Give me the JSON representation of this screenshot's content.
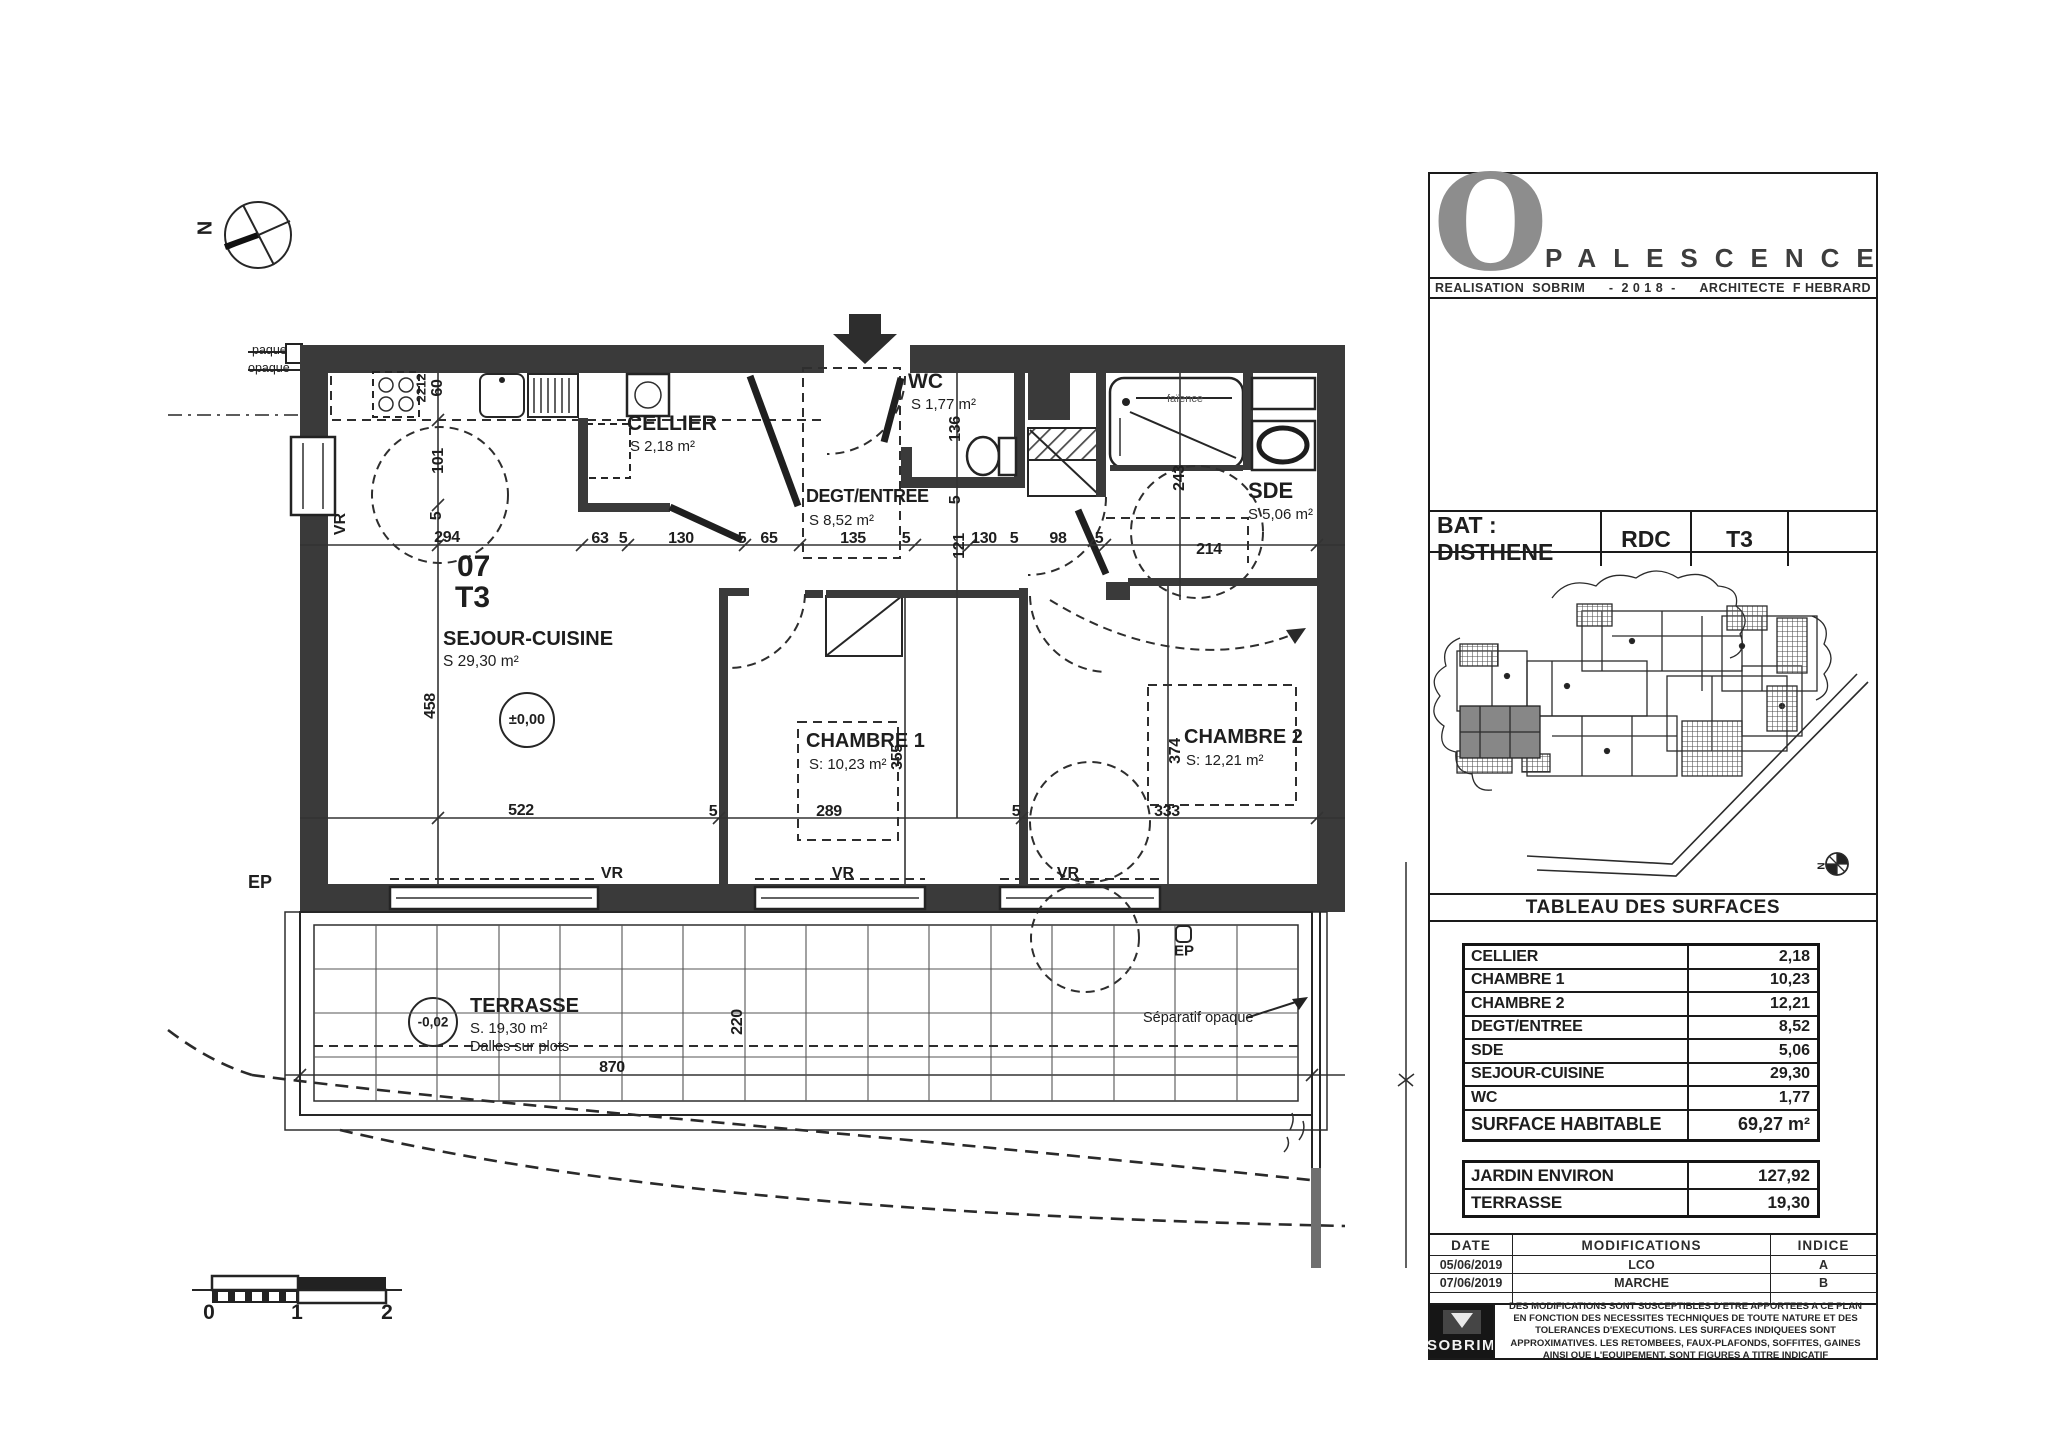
{
  "plan": {
    "compass_n": "N",
    "unit_number": "07",
    "unit_type": "T3",
    "clip_label_1": "paque",
    "clip_label_2": "opaque",
    "rooms": {
      "sejour": {
        "name": "SEJOUR-CUISINE",
        "area": "S 29,30 m²"
      },
      "cellier": {
        "name": "CELLIER",
        "area": "S 2,18 m²"
      },
      "degt": {
        "name": "DEGT/ENTREE",
        "area": "S 8,52 m²"
      },
      "wc": {
        "name": "WC",
        "area": "S 1,77 m²"
      },
      "sde": {
        "name": "SDE",
        "area": "S 5,06 m²"
      },
      "chambre1": {
        "name": "CHAMBRE 1",
        "area": "S: 10,23 m²"
      },
      "chambre2": {
        "name": "CHAMBRE 2",
        "area": "S: 12,21 m²"
      },
      "terrasse": {
        "name": "TERRASSE",
        "area": "S. 19,30 m²",
        "note": "Dalles sur plots"
      }
    },
    "levels": {
      "interior": "±0,00",
      "terrace": "-0,02"
    },
    "window_label": "VR",
    "ep_label": "EP",
    "faience_label": "faïence",
    "separatif_label": "Séparatif opaque",
    "scale_bar": {
      "s0": "0",
      "s1": "1",
      "s2": "2"
    },
    "dims": [
      "294",
      "63",
      "5",
      "130",
      "5",
      "65",
      "135",
      "5",
      "121",
      "130",
      "5",
      "98",
      "5",
      "214",
      "2212",
      "60",
      "101",
      "5",
      "458",
      "136",
      "5",
      "243",
      "522",
      "5",
      "289",
      "5",
      "333",
      "355",
      "374",
      "220",
      "870"
    ]
  },
  "titleblock": {
    "logo_o": "O",
    "logo_rest": "PALESCENCE",
    "credits": {
      "left": "REALISATION  SOBRIM",
      "center": "-  2 0 1 8  -",
      "right": "ARCHITECTE  F HEBRARD"
    },
    "bat": {
      "label": "BAT : DISTHENE",
      "level": "RDC",
      "type": "T3",
      "extra": ""
    },
    "site_compass_n": "N",
    "tableau_title": "TABLEAU DES SURFACES",
    "surfaces": {
      "rows": [
        [
          "CELLIER",
          "2,18"
        ],
        [
          "CHAMBRE 1",
          "10,23"
        ],
        [
          "CHAMBRE 2",
          "12,21"
        ],
        [
          "DEGT/ENTREE",
          "8,52"
        ],
        [
          "SDE",
          "5,06"
        ],
        [
          "SEJOUR-CUISINE",
          "29,30"
        ],
        [
          "WC",
          "1,77"
        ]
      ],
      "total": [
        "SURFACE HABITABLE",
        "69,27 m²"
      ]
    },
    "exterior": {
      "rows": [
        [
          "JARDIN ENVIRON",
          "127,92"
        ],
        [
          "TERRASSE",
          "19,30"
        ]
      ]
    },
    "revisions": {
      "headers": [
        "DATE",
        "MODIFICATIONS",
        "INDICE"
      ],
      "rows": [
        [
          "05/06/2019",
          "LCO",
          "A"
        ],
        [
          "07/06/2019",
          "MARCHE",
          "B"
        ],
        [
          "",
          "",
          ""
        ]
      ]
    },
    "sobrim_logo": "SOBRIM",
    "disclaimer": "DES MODIFICATIONS SONT SUSCEPTIBLES D'ETRE APPORTEES A CE PLAN EN FONCTION DES NECESSITES TECHNIQUES DE TOUTE NATURE ET DES TOLERANCES D'EXECUTIONS. LES SURFACES INDIQUEES SONT APPROXIMATIVES. LES RETOMBEES, FAUX-PLAFONDS, SOFFITES, GAINES AINSI QUE L'EQUIPEMENT, SONT FIGURES A TITRE INDICATIF"
  }
}
